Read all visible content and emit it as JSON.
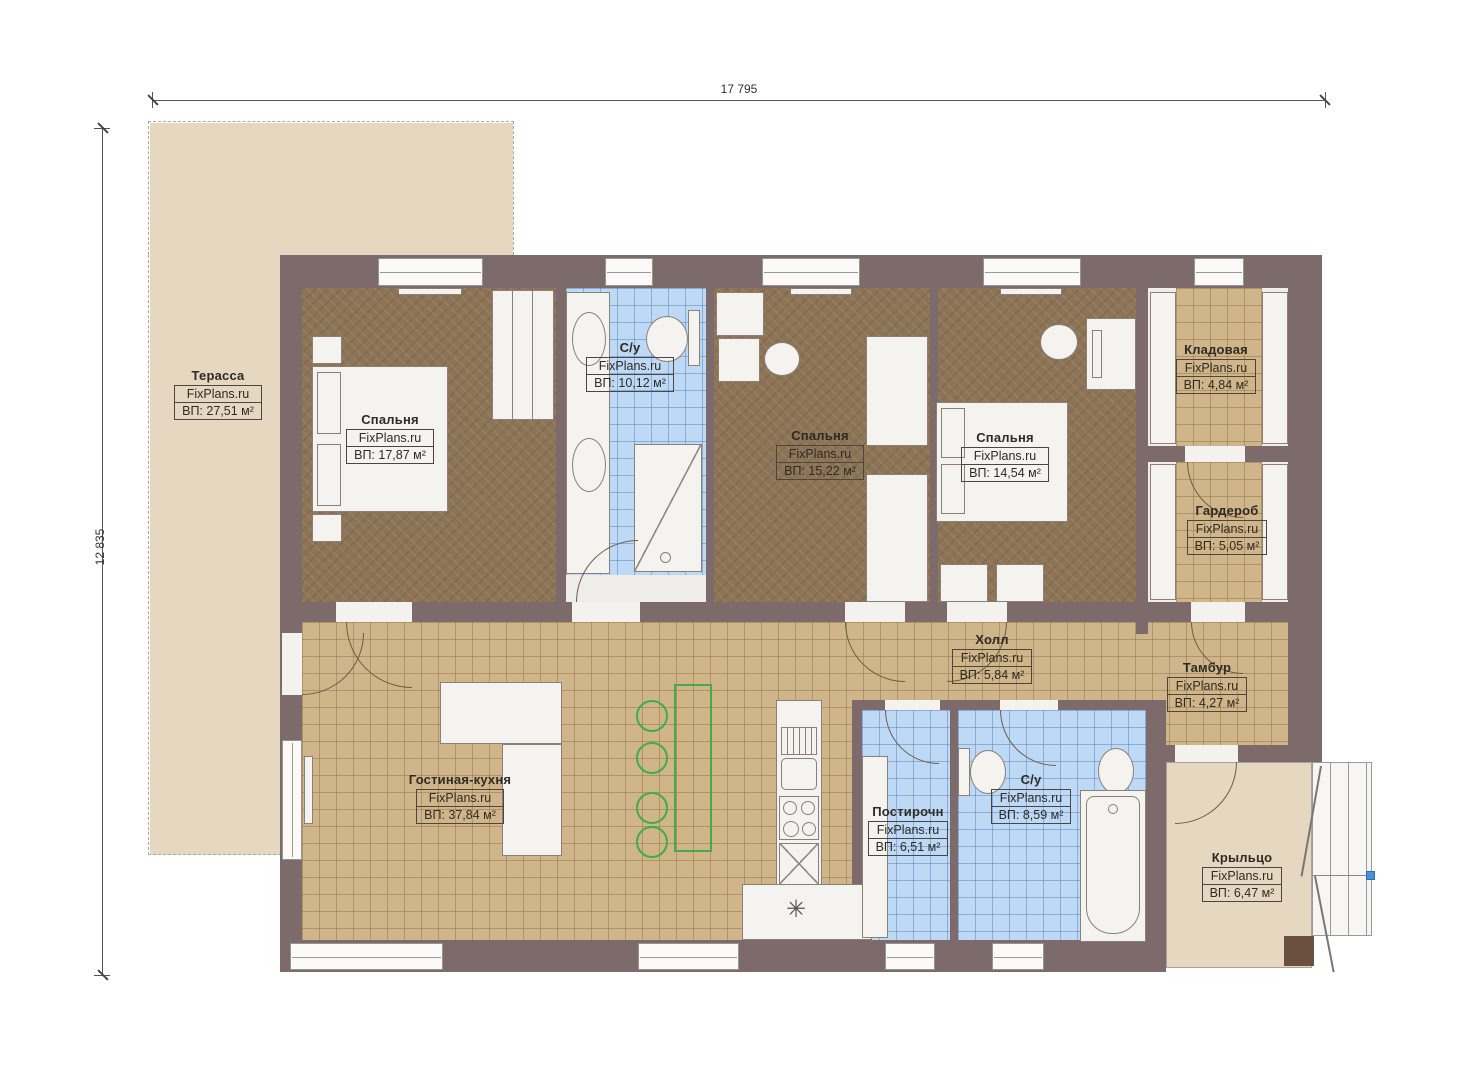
{
  "branding": "FixPlans.ru",
  "dimensions": {
    "top": "17 795",
    "left": "12 835"
  },
  "rooms": [
    {
      "key": "terrace",
      "name": "Терасса",
      "brand": "FixPlans.ru",
      "area": "ВП: 27,51 м²"
    },
    {
      "key": "bedroom-1",
      "name": "Спальня",
      "brand": "FixPlans.ru",
      "area": "ВП: 17,87 м²"
    },
    {
      "key": "bathroom-top",
      "name": "С/у",
      "brand": "FixPlans.ru",
      "area": "ВП: 10,12 м²"
    },
    {
      "key": "bedroom-2",
      "name": "Спальня",
      "brand": "FixPlans.ru",
      "area": "ВП: 15,22 м²"
    },
    {
      "key": "bedroom-3",
      "name": "Спальня",
      "brand": "FixPlans.ru",
      "area": "ВП: 14,54 м²"
    },
    {
      "key": "storage",
      "name": "Кладовая",
      "brand": "FixPlans.ru",
      "area": "ВП: 4,84 м²"
    },
    {
      "key": "wardrobe",
      "name": "Гардероб",
      "brand": "FixPlans.ru",
      "area": "ВП: 5,05 м²"
    },
    {
      "key": "hall",
      "name": "Холл",
      "brand": "FixPlans.ru",
      "area": "ВП: 5,84 м²"
    },
    {
      "key": "vestibule",
      "name": "Тамбур",
      "brand": "FixPlans.ru",
      "area": "ВП: 4,27 м²"
    },
    {
      "key": "living-kitchen",
      "name": "Гостиная-кухня",
      "brand": "FixPlans.ru",
      "area": "ВП: 37,84 м²"
    },
    {
      "key": "laundry",
      "name": "Постирочн",
      "brand": "FixPlans.ru",
      "area": "ВП: 6,51 м²"
    },
    {
      "key": "bathroom-bottom",
      "name": "С/у",
      "brand": "FixPlans.ru",
      "area": "ВП: 8,59 м²"
    },
    {
      "key": "porch",
      "name": "Крыльцо",
      "brand": "FixPlans.ru",
      "area": "ВП: 6,47 м²"
    }
  ],
  "icons": {
    "fridge_snowflake": "✳"
  },
  "colors": {
    "wall": "#7d6a6a",
    "bedroom_floor": "#8d7456",
    "tile_floor": "#cfb589",
    "bath_tile": "#bdd9f5",
    "terrace": "#e6d7c1",
    "furniture_green": "#3fae47",
    "marker_blue": "#4a90d9"
  }
}
